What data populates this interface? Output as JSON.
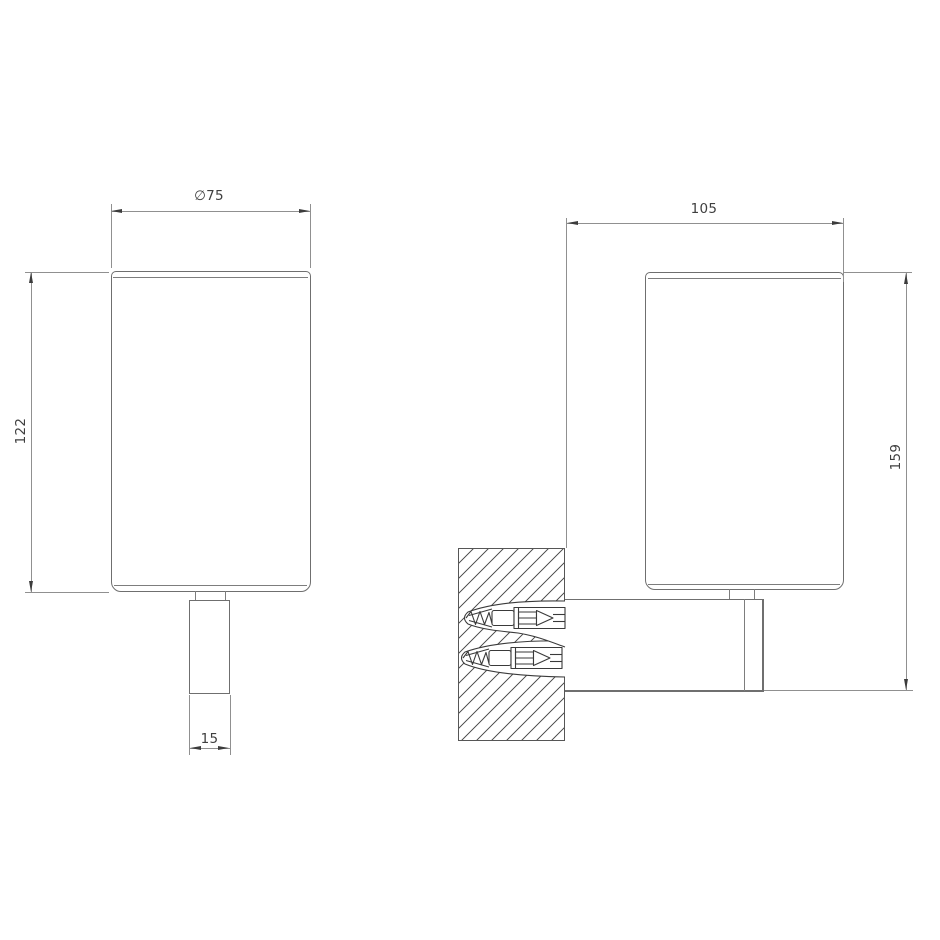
{
  "drawing": {
    "type": "technical-dimension-drawing",
    "dimensions": {
      "diameter": "∅75",
      "body_height": "122",
      "stem_width": "15",
      "wall_depth": "105",
      "overall_height": "159"
    },
    "icons": {
      "wall_section": "hatched-masonry-wall-icon",
      "fastener": "screw-with-wall-plug-icon"
    },
    "colors": {
      "background": "#ffffff",
      "object_line": "#6f6f6f",
      "dimension_line": "#909090",
      "arrow_and_text": "#3c3c3c",
      "hatch": "#585858"
    }
  }
}
